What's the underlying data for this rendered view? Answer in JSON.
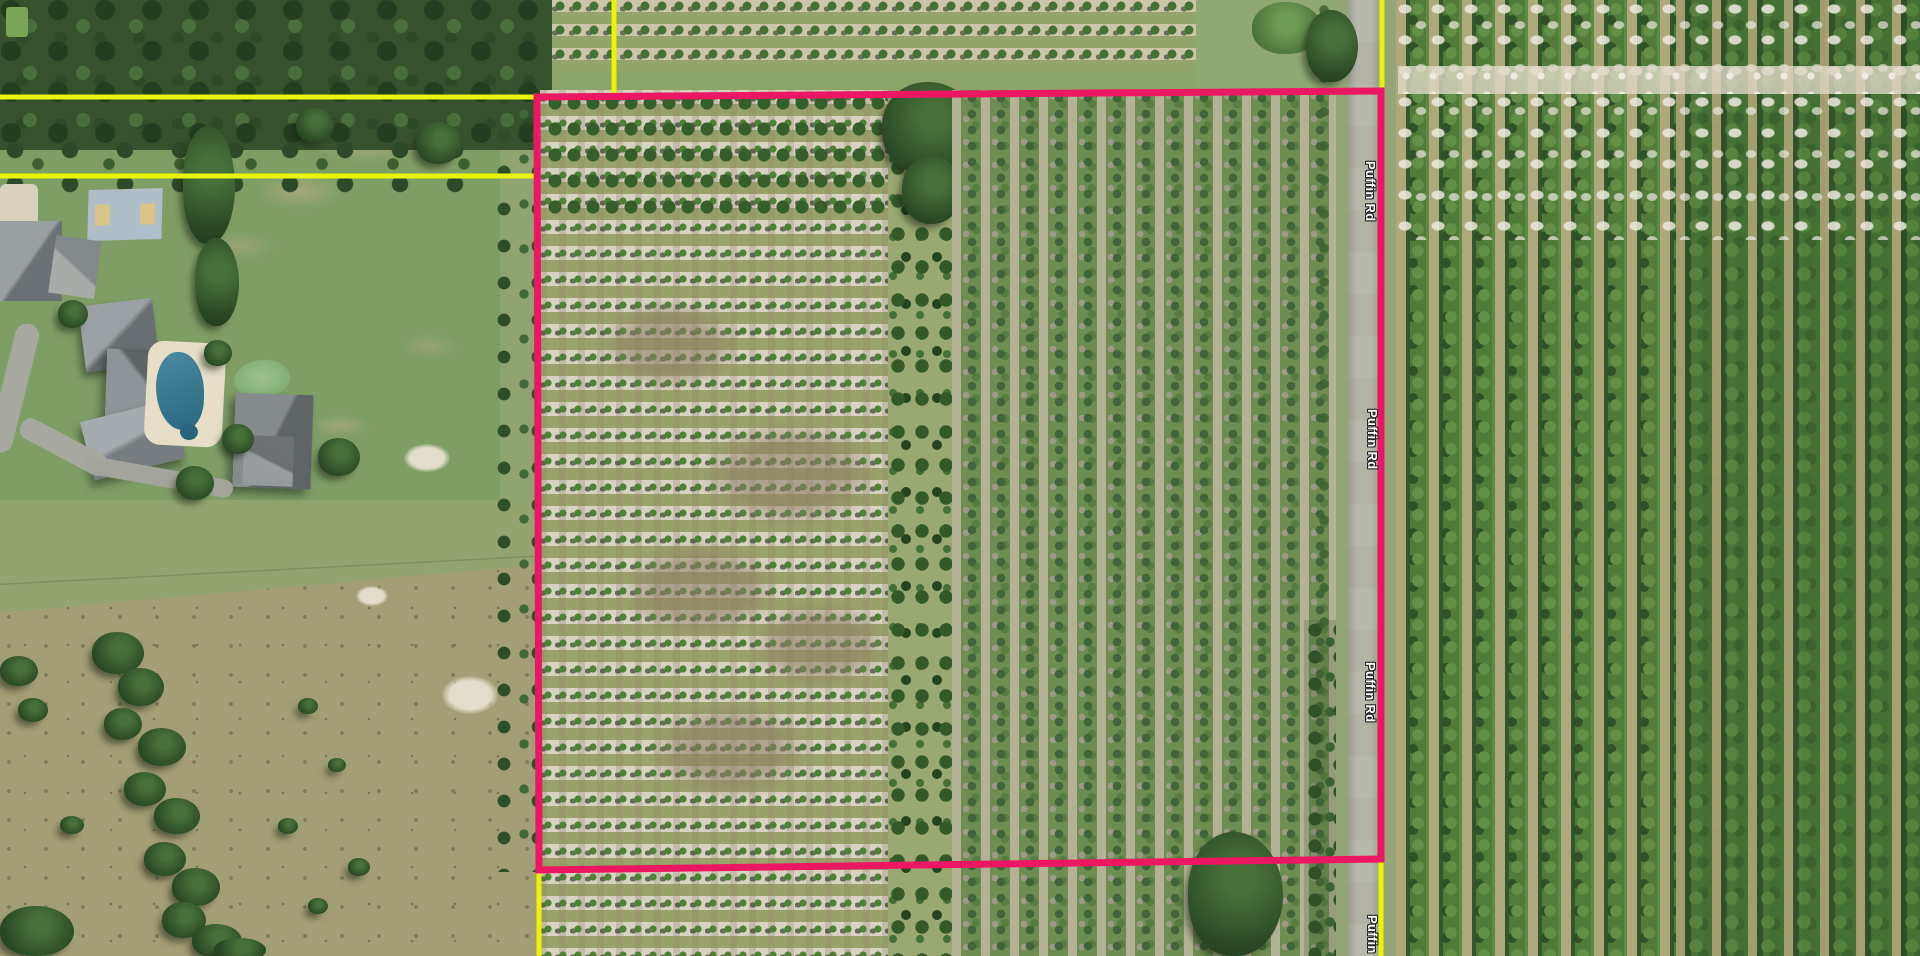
{
  "map": {
    "view": "aerial-imagery",
    "road_name": "Puffin Rd",
    "road_labels": [
      {
        "text": "Puffin Rd"
      },
      {
        "text": "Puffin Rd"
      },
      {
        "text": "Puffin Rd"
      },
      {
        "text": "Puffin Rd"
      }
    ],
    "colors": {
      "parcel_boundary": "#EC1762",
      "neighbor_boundary": "#EAF500",
      "label_text": "#FFFFFF",
      "label_halo": "#222222"
    },
    "parcel_outline": {
      "points": "537,97 1381,91 1381,859 539,870"
    },
    "neighbor_lines": [
      {
        "points": "0,97 534,97"
      },
      {
        "points": "0,176 537,176"
      },
      {
        "points": "614,0 614,95"
      },
      {
        "points": "1382,0 1382,89"
      },
      {
        "points": "1381,861 1381,956"
      },
      {
        "points": "539,872 539,956"
      }
    ]
  }
}
